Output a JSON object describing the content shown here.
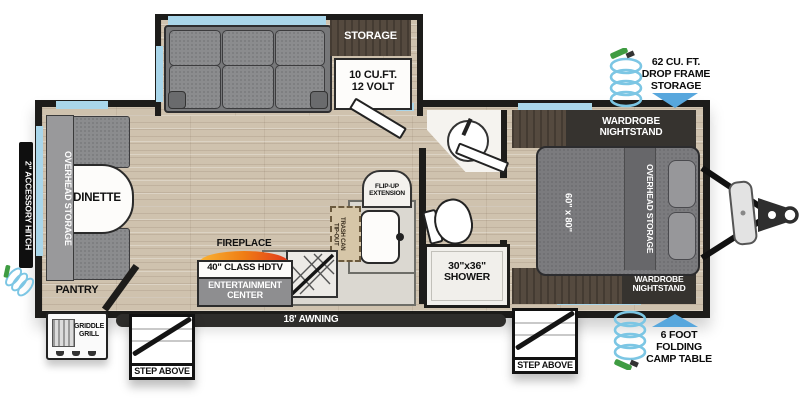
{
  "plan": {
    "slideout": {
      "storage": "STORAGE",
      "fridge1": "10 CU.FT.",
      "fridge2": "12 VOLT"
    },
    "dinette": {
      "label": "DINETTE",
      "overhead": "OVERHEAD STORAGE"
    },
    "left": {
      "hitch": "2\" ACCESSORY HITCH",
      "pantry": "PANTRY",
      "griddle1": "GRIDDLE",
      "griddle2": "GRILL"
    },
    "kitchen": {
      "fireplace": "FIREPLACE",
      "tv": "40\" CLASS HDTV",
      "ent1": "ENTERTAINMENT",
      "ent2": "CENTER",
      "flip1": "FLIP-UP",
      "flip2": "EXTENSION",
      "trash1": "TIP-OUT",
      "trash2": "TRASH CAN"
    },
    "bath": {
      "shower1": "30\"x36\"",
      "shower2": "SHOWER"
    },
    "bedroom": {
      "bed_size": "60\" x 80\"",
      "overhead": "OVERHEAD STORAGE",
      "wardrobe1": "WARDROBE",
      "wardrobe2": "NIGHTSTAND"
    },
    "exterior": {
      "awning": "18' AWNING",
      "step": "STEP ABOVE",
      "drop1": "62 CU. FT.",
      "drop2": "DROP FRAME",
      "drop3": "STORAGE",
      "camp1": "6 FOOT",
      "camp2": "FOLDING",
      "camp3": "CAMP TABLE"
    }
  },
  "colors": {
    "wall": "#1d1c1a",
    "window": "#a9d6ea",
    "arrow_blue": "#58a7dd",
    "hose_blue": "#7cc6e4",
    "nozzle_green": "#3f9c42",
    "flame_start": "#f9b233",
    "flame_end": "#e2391b"
  }
}
